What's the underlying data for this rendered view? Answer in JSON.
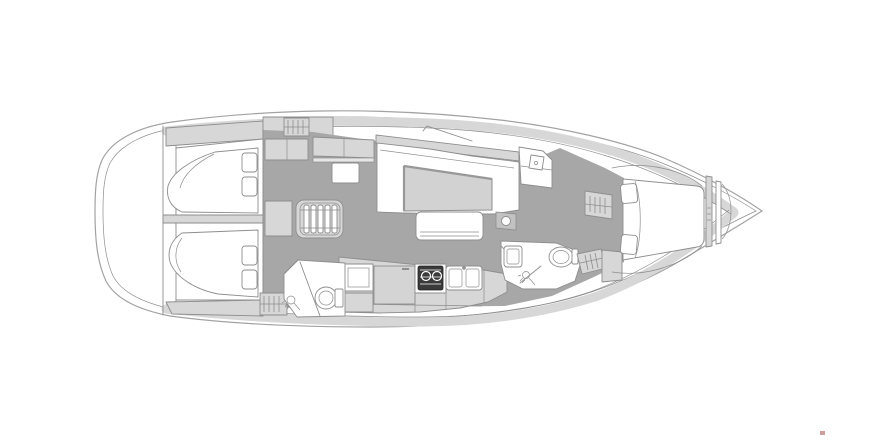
{
  "page": {
    "background": "#ffffff"
  },
  "colors": {
    "bg": "#ffffff",
    "line": "#8e8e8e",
    "hull_line": "#a2a2a2",
    "floor": "#a7a7a7",
    "furniture": "#d7d7d7",
    "furniture_dark": "#c2c2c2",
    "table": "#d2d2d2",
    "stove": "#3a3a3a",
    "mark": "#bb7f7f"
  },
  "plan": {
    "label": "Sailboat interior deck plan, bow facing right",
    "type": "yacht-interior-floor-plan",
    "orientation": "bow-right",
    "elements": {
      "hull": "hull outline with side decks",
      "swim-platform": "rounded transom / swim platform (stern, left)",
      "aft-cabin-port": "aft double berth cabin with two pillows (top left)",
      "aft-cabin-starboard": "aft double berth cabin with two pillows (bottom left)",
      "cabin-divider": "centerline bulkhead between aft cabins",
      "companionway-stairs": "companionway steps icon (center)",
      "nav-seat": "navigation bench seat",
      "chart-table": "chart table",
      "salon-settee": "U-shaped salon settee",
      "salon-table": "salon dining table",
      "salon-bench": "free-standing salon bench",
      "galley-counter": "galley counter run",
      "fridge-icon": "top-loading fridge lid",
      "stove-icon": "gimbaled two-burner stove",
      "sink-icon": "double galley sink",
      "aft-head": "aft bathroom",
      "toilet-icon": "marine toilet",
      "shower-icon": "shower head symbol",
      "forward-head": "forward bathroom with sink and toilet",
      "hanging-locker-icon": "hatched hanging locker symbol",
      "forward-cabin": "forward cabin with island berth and pillows",
      "anchor-locker": "bow anchor locker",
      "watermark-dot": "small reddish mark, bottom right"
    }
  }
}
